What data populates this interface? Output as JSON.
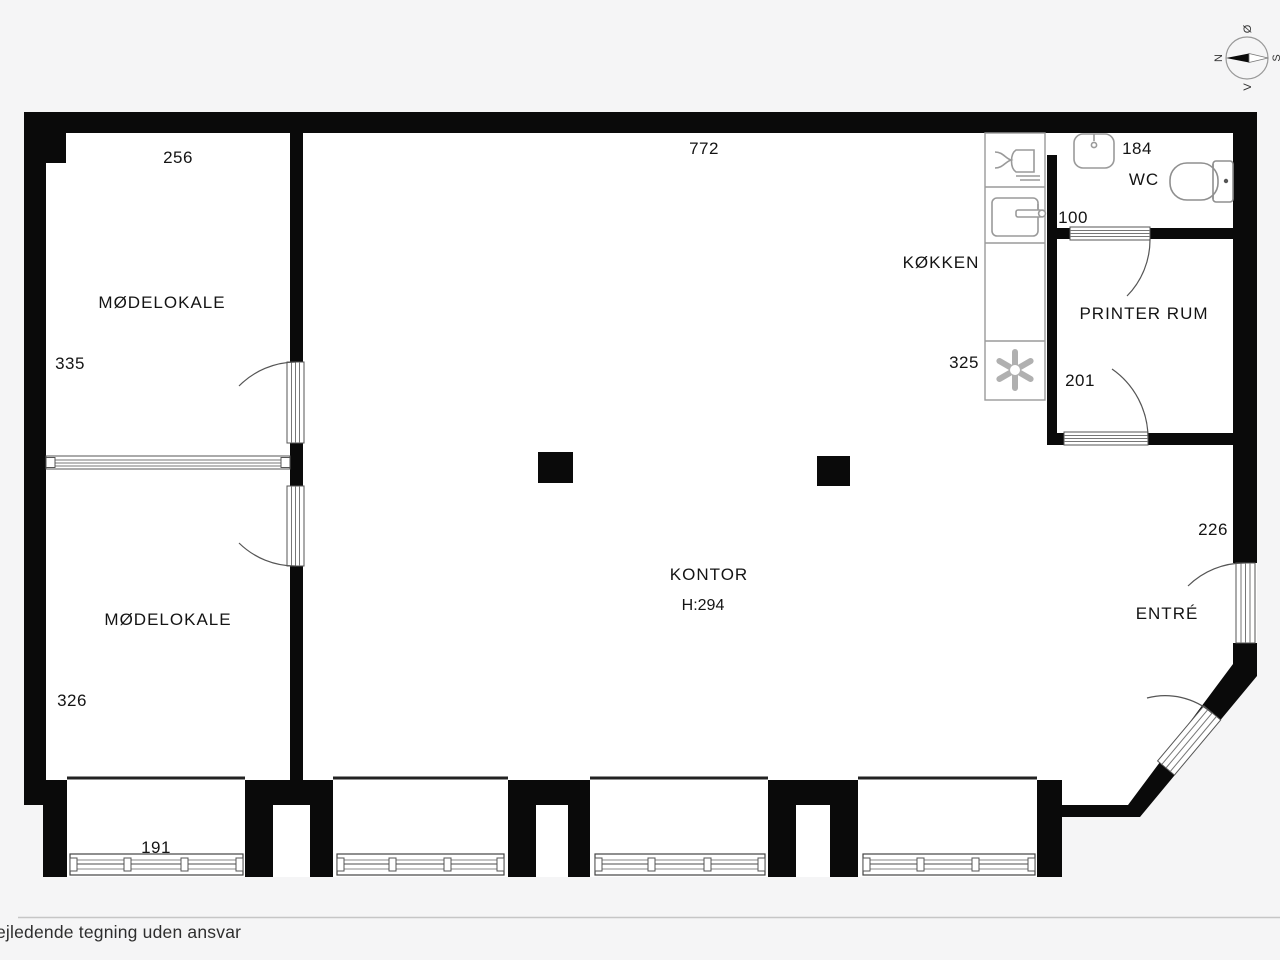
{
  "rooms": {
    "meeting1": {
      "label": "MØDELOKALE",
      "width": "256",
      "depth": "335"
    },
    "meeting2": {
      "label": "MØDELOKALE",
      "depth": "326"
    },
    "kontor": {
      "label": "KONTOR",
      "height": "H:294",
      "width": "772"
    },
    "kitchen": {
      "label": "KØKKEN",
      "dim": "325"
    },
    "printer": {
      "label": "PRINTER RUM",
      "door": "201"
    },
    "wc": {
      "label": "WC",
      "width": "184",
      "door": "100"
    },
    "entry": {
      "label": "ENTRÉ",
      "door": "226"
    }
  },
  "bay": {
    "window": "191"
  },
  "compass": {
    "n": "N",
    "s": "S",
    "e": "Ø",
    "w": "V"
  },
  "footer": {
    "disclaimer": "ejledende tegning uden ansvar"
  },
  "colors": {
    "wall": "#0a0a0a",
    "background": "#f5f5f6",
    "room": "#ffffff",
    "fixture": "#9a9a9a",
    "arc": "#555555"
  }
}
